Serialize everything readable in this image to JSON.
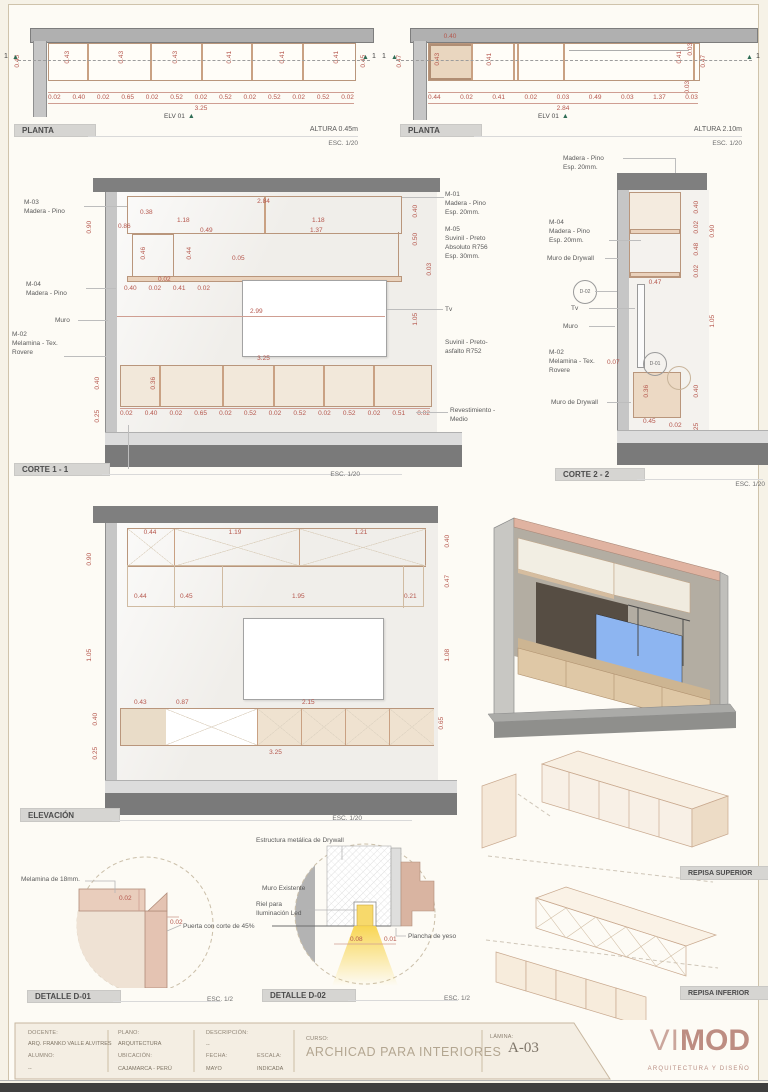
{
  "colors": {
    "dim": "#b5564c",
    "wood_line": "#b9967c",
    "logo_accent": "#c49a90",
    "marker_green": "#2f6d55"
  },
  "views": {
    "planta1": {
      "title": "PLANTA",
      "altura": "ALTURA 0.45m",
      "esc": "ESC. 1/20",
      "marker": "1",
      "elv": "ELV 01",
      "dim_left": "0.45",
      "dim_right": "0.45",
      "dims_compartments": [
        "0.43",
        "0.43",
        "0.43",
        "0.41",
        "0.41",
        "0.41"
      ],
      "dims_bottom": [
        "0.02",
        "0.40",
        "0.02",
        "0.65",
        "0.02",
        "0.52",
        "0.02",
        "0.52",
        "0.02",
        "0.52",
        "0.02",
        "0.52",
        "0.02"
      ],
      "total": "3.25"
    },
    "planta2": {
      "title": "PLANTA",
      "altura": "ALTURA 2.10m",
      "esc": "ESC. 1/20",
      "marker": "1",
      "elv": "ELV 01",
      "dim_left": "0.47",
      "dim_box_h": "0.43",
      "dim_box_w": "0.40",
      "dim_mid": "0.41",
      "dims_right": [
        "0.41",
        "0.03",
        "0.47"
      ],
      "dim_right_low": "0.03",
      "dims_bottom": [
        "0.44",
        "0.02",
        "0.41",
        "0.02",
        "0.03",
        "0.49",
        "0.03",
        "1.37",
        "0.03"
      ],
      "total": "2.84"
    },
    "corte1": {
      "title": "CORTE 1 - 1",
      "esc": "ESC. 1/20",
      "zocalo": "Zócalo",
      "labels_left": [
        "M-03\nMadera - Pino",
        "M-04\nMadera - Pino",
        "Muro",
        "M-02\nMelamina - Tex.\nRovere"
      ],
      "labels_right": [
        "M-01\nMadera - Pino\nEsp. 20mm.",
        "M-05\nSuvinil - Preto\nAbsoluto R756\nEsp. 30mm.",
        "Tv",
        "Suvinil -  Preto-\nasfalto R752",
        "Revestimiento -\nMedio"
      ],
      "dim_total_top": "2.84",
      "dim_band": "0.38",
      "dim_half_l": "1.18",
      "dim_half_r": "1.18",
      "dim_086": "0.86",
      "dim_046": "0.46",
      "dim_044": "0.44",
      "dim_049": "0.49",
      "dim_137": "1.37",
      "dim_005": "0.05",
      "dim_left_col": "0.90",
      "dim_002": "0.02",
      "dims_small_row": [
        "0.40",
        "0.02",
        "0.41",
        "0.02"
      ],
      "dims_right_col": [
        "0.40",
        "0.50",
        "0.03",
        "1.05"
      ],
      "dim_tv": "2.99",
      "dim_total_mid": "3.25",
      "dim_036": "0.36",
      "dims_left_low": [
        "0.40",
        "0.25"
      ],
      "dims_bottom": [
        "0.02",
        "0.40",
        "0.02",
        "0.65",
        "0.02",
        "0.52",
        "0.02",
        "0.52",
        "0.02",
        "0.52",
        "0.02",
        "0.51",
        "0.02"
      ]
    },
    "corte2": {
      "title": "CORTE 2 - 2",
      "esc": "ESC. 1/20",
      "label_top": "Madera - Pino\nEsp. 20mm.",
      "label_m04": "M-04\nMadera - Pino\nEsp. 20mm.",
      "label_drywall_up": "Muro de Drywall",
      "label_drywall_low": "Muro de Drywall",
      "label_d02": "D-02",
      "label_d01": "D-01",
      "label_tv": "Tv",
      "label_muro": "Muro",
      "label_m02": "M-02\nMelamina - Tex.\nRovere",
      "dim_040a": "0.40",
      "dim_002a": "0.02",
      "dim_048": "0.48",
      "dim_002b": "0.02",
      "dim_090": "0.90",
      "dim_047": "0.47",
      "dim_105": "1.05",
      "dim_007": "0.07",
      "dim_036": "0.36",
      "dim_040b": "0.40",
      "dim_045": "0.45",
      "dim_002c": "0.02",
      "dim_025": "0.25"
    },
    "elevacion": {
      "title": "ELEVACIÓN",
      "esc": "ESC. 1/20",
      "dims_top": [
        "0.44",
        "1.19",
        "1.21"
      ],
      "dims_mid": [
        "0.44",
        "0.45",
        "1.95",
        "0.21"
      ],
      "dims_row3": [
        "0.43",
        "0.87",
        "2.15"
      ],
      "dims_left": [
        "0.90",
        "1.05",
        "0.40",
        "0.25"
      ],
      "dims_right": [
        "0.40",
        "0.47",
        "1.08",
        "0.65"
      ],
      "total": "3.25"
    },
    "detalle1": {
      "title": "DETALLE D-01",
      "esc": "ESC. 1/2",
      "label_melamina": "Melamina de 18mm.",
      "label_puerta": "Puerta con corte de 45%",
      "dim_a": "0.02",
      "dim_b": "0.02"
    },
    "detalle2": {
      "title": "DETALLE D-02",
      "esc": "ESC. 1/2",
      "label_estructura": "Estructura metálica de Drywall",
      "label_muro": "Muro Existente",
      "label_riel": "Riel para\nIluminación Led",
      "label_plancha": "Plancha de yeso",
      "dim_a": "0.08",
      "dim_b": "0.01"
    },
    "repisas": {
      "superior": "REPISA SUPERIOR",
      "inferior": "REPISA INFERIOR"
    }
  },
  "titleblock": {
    "docente_label": "DOCENTE:",
    "docente": "ARQ. FRANKO VALLE ALVITRES",
    "alumno_label": "ALUMNO:",
    "alumno": "--",
    "plano_label": "PLANO:",
    "plano": "ARQUITECTURA",
    "ubicacion_label": "UBICACIÓN:",
    "ubicacion": "CAJAMARCA - PERÚ",
    "descripcion_label": "DESCRIPCIÓN:",
    "descripcion": "--",
    "fecha_label": "FECHA:",
    "fecha": "MAYO",
    "escala_label": "ESCALA:",
    "escala": "INDICADA",
    "curso_label": "CURSO:",
    "curso": "ARCHICAD PARA INTERIORES",
    "lamina_label": "LÁMINA:",
    "lamina": "A-03",
    "logo_vi": "VI",
    "logo_mod": "MOD",
    "logo_sub": "ARQUITECTURA Y DISEÑO"
  }
}
